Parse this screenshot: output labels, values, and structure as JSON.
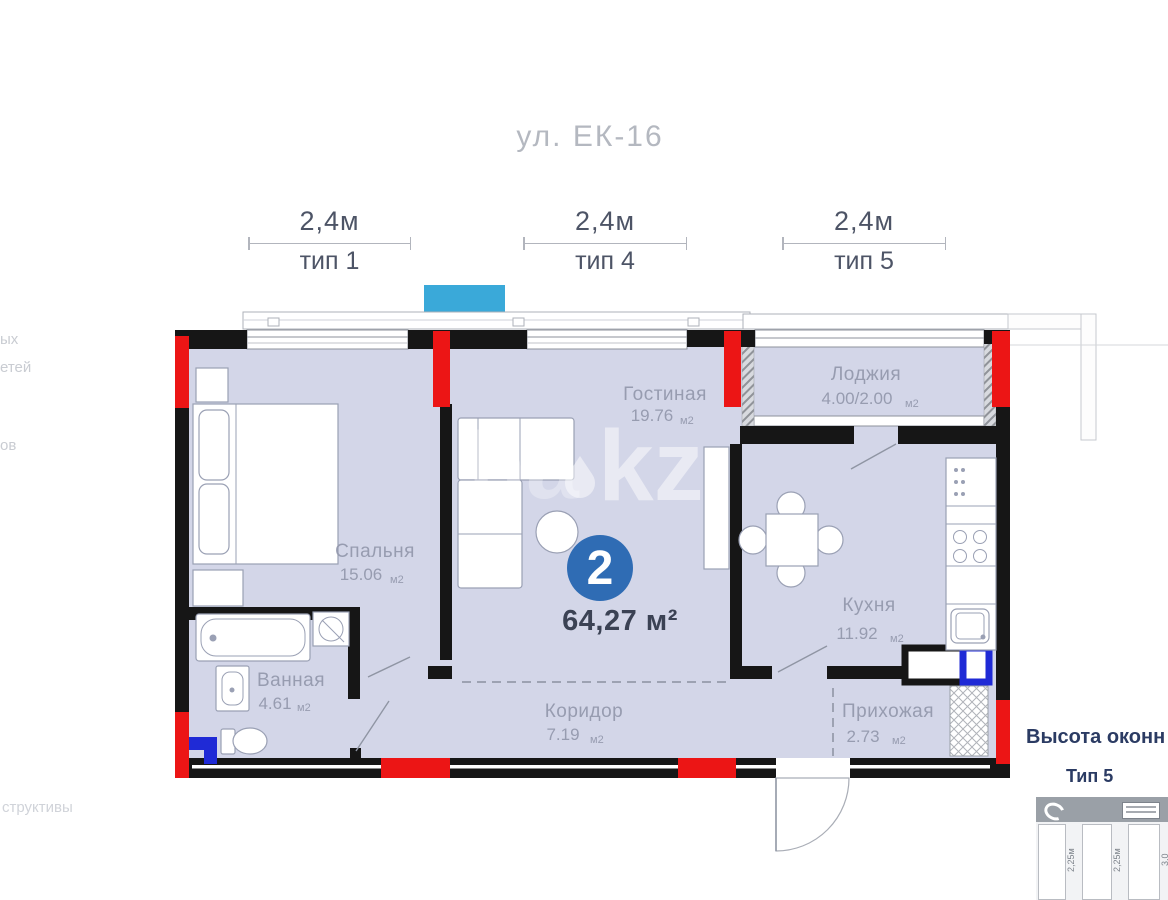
{
  "header": {
    "title": "ул. ЕК-16"
  },
  "dimension_labels": [
    {
      "length": "2,4м",
      "type": "тип 1"
    },
    {
      "length": "2,4м",
      "type": "тип 4"
    },
    {
      "length": "2,4м",
      "type": "тип 5"
    }
  ],
  "apartment": {
    "room_count": "2",
    "total_area": "64,27 м²"
  },
  "rooms": {
    "living": {
      "name": "Гостиная",
      "area": "19.76",
      "unit": "м2"
    },
    "loggia": {
      "name": "Лоджия",
      "area": "4.00/2.00",
      "unit": "м2"
    },
    "bedroom": {
      "name": "Спальня",
      "area": "15.06",
      "unit": "м2"
    },
    "kitchen": {
      "name": "Кухня",
      "area": "11.92",
      "unit": "м2"
    },
    "bathroom": {
      "name": "Ванная",
      "area": "4.61",
      "unit": "м2"
    },
    "corridor": {
      "name": "Коридор",
      "area": "7.19",
      "unit": "м2"
    },
    "hallway": {
      "name": "Прихожая",
      "area": "2.73",
      "unit": "м2"
    }
  },
  "watermark": {
    "partial": "ha",
    "main": "kz"
  },
  "sidebar": {
    "title": "Высота оконн",
    "window_type": "Тип 5",
    "pane_labels": [
      "2,25м",
      "2,25м",
      "3,0"
    ]
  },
  "left_edge_fragments": {
    "f1": "ых",
    "f2": "етей",
    "f3": "ов",
    "f4": "структивы"
  },
  "colors": {
    "floor": "#d3d6e8",
    "wall": "#161616",
    "column_red": "#ec1515",
    "plumbing_blue": "#1f2ad6",
    "marker_cyan": "#3aa9d9",
    "badge_blue": "#2f6cb4",
    "label_gray": "#979cb0",
    "accent_navy": "#2b3b63"
  }
}
